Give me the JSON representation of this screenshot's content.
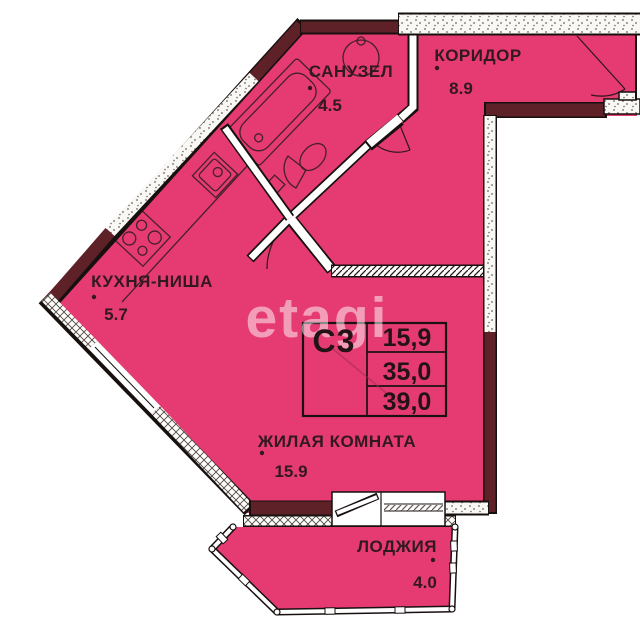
{
  "plan": {
    "watermark": "etagi",
    "rooms": [
      {
        "name": "САНУЗЕЛ",
        "area": "4.5"
      },
      {
        "name": "КОРИДОР",
        "area": "8.9"
      },
      {
        "name": "КУХНЯ-НИША",
        "area": "5.7"
      },
      {
        "name": "ЖИЛАЯ КОМНАТА",
        "area": "15.9"
      },
      {
        "name": "ЛОДЖИЯ",
        "area": "4.0"
      }
    ],
    "stamp": {
      "unit_type": "С3",
      "living_area": "15,9",
      "apartment_area": "35,0",
      "total_area": "39,0"
    },
    "colors": {
      "floor_fill": "#e63b72",
      "wall_accent": "#5d2127",
      "outline": "#17100f"
    }
  }
}
